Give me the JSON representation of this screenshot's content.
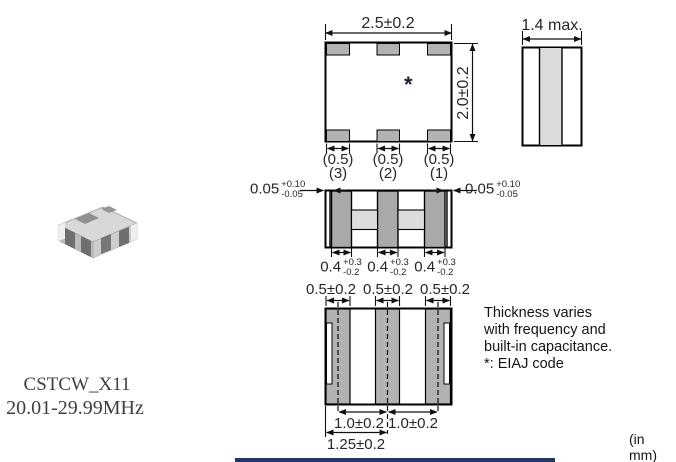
{
  "page": {
    "units_note": "(in mm)"
  },
  "product": {
    "part_number": "CSTCW_X11",
    "frequency_range": "20.01-29.99MHz"
  },
  "note": {
    "lines": [
      "Thickness varies",
      "with frequency and",
      "built-in capacitance."
    ],
    "eiaj_line": "*: EIAJ code"
  },
  "top_view": {
    "width_dim": "2.5±0.2",
    "height_dim": "2.0±0.2",
    "eiaj_mark": "*",
    "pad_width_dims": [
      "(0.5)",
      "(0.5)",
      "(0.5)"
    ],
    "terminal_numbers": [
      "(3)",
      "(2)",
      "(1)"
    ]
  },
  "side_view": {
    "thickness_dim": "1.4 max."
  },
  "inner_view": {
    "end_gap_left": {
      "value": "0.05",
      "plus": "+0.10",
      "minus": "-0.05"
    },
    "end_gap_right": {
      "value": "0.05",
      "plus": "+0.10",
      "minus": "-0.05"
    },
    "electrode_widths": [
      {
        "value": "0.4",
        "plus": "+0.3",
        "minus": "-0.2"
      },
      {
        "value": "0.4",
        "plus": "+0.3",
        "minus": "-0.2"
      },
      {
        "value": "0.4",
        "plus": "+0.3",
        "minus": "-0.2"
      }
    ]
  },
  "bottom_view": {
    "terminal_width_dims": [
      "0.5±0.2",
      "0.5±0.2",
      "0.5±0.2"
    ],
    "pitch_dims": [
      "1.0±0.2",
      "1.0±0.2"
    ],
    "half_width_dim": "1.25±0.2"
  },
  "colors": {
    "pad_gray": "#b2b2b2",
    "electrode_gray": "#a9a9a9",
    "light_gray": "#dcdcdc",
    "accent_navy": "#1f3864"
  }
}
